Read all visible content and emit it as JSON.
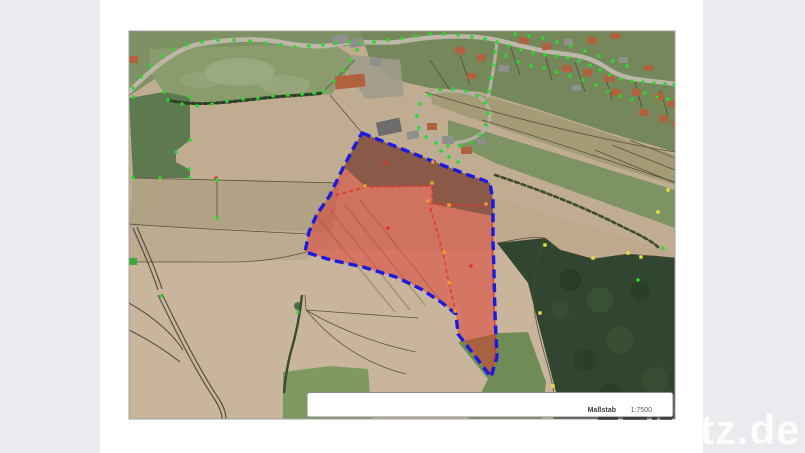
{
  "window": {
    "background_color": "#e9ebee",
    "paper_color": "#ffffff"
  },
  "map": {
    "scale_box": {
      "label": "Maßstab",
      "value": "1:7500"
    },
    "watermark_text": "tz.de",
    "colors": {
      "selection_outline": "#1b1bdf",
      "selection_fill": "rgba(224,56,44,0.5)",
      "selection_fill_dark": "rgba(45,55,40,0.42)",
      "cadastral_line": "#e6392b",
      "survey_point": "#2bd82b",
      "boundary_point": "#e6e03c",
      "vertex_point": "#f59a23",
      "label_point": "#e03125",
      "house_red": "#b2613f",
      "house_gray": "#8f8f8d",
      "house_dark": "#6c6c6a",
      "house_shed": "#3aa83a",
      "scalebar": "#3f3f3f"
    },
    "selected_parcel": {
      "outer": [
        [
          362,
          133
        ],
        [
          402,
          149
        ],
        [
          442,
          165
        ],
        [
          471,
          176
        ],
        [
          483,
          180
        ],
        [
          490,
          183
        ],
        [
          493,
          201
        ],
        [
          493,
          242
        ],
        [
          494,
          272
        ],
        [
          495,
          314
        ],
        [
          497,
          357
        ],
        [
          491,
          377
        ],
        [
          458,
          334
        ],
        [
          456,
          314
        ],
        [
          441,
          302
        ],
        [
          421,
          289
        ],
        [
          396,
          277
        ],
        [
          363,
          267
        ],
        [
          331,
          260
        ],
        [
          305,
          252
        ],
        [
          309,
          232
        ],
        [
          317,
          214
        ],
        [
          329,
          197
        ],
        [
          343,
          168
        ],
        [
          354,
          147
        ]
      ],
      "dark_overlay": [
        [
          362,
          133
        ],
        [
          471,
          176
        ],
        [
          483,
          180
        ],
        [
          490,
          183
        ],
        [
          493,
          201
        ],
        [
          493,
          216
        ],
        [
          453,
          208
        ],
        [
          433,
          204
        ],
        [
          432,
          186
        ],
        [
          366,
          187
        ],
        [
          344,
          167
        ],
        [
          354,
          147
        ]
      ]
    },
    "inner_lines": [
      "M329,197 L366,187 L432,186 L432,204 L487,206",
      "M428,201 C436,226 442,249 445,263 C448,280 452,297 456,313",
      "M492,216 C493,252 493,292 495,330 C496,348 494,362 490,375"
    ],
    "green_points": [
      [
        133,
        88
      ],
      [
        141,
        77
      ],
      [
        150,
        66
      ],
      [
        161,
        56
      ],
      [
        173,
        49
      ],
      [
        187,
        45
      ],
      [
        202,
        42
      ],
      [
        218,
        40
      ],
      [
        234,
        40
      ],
      [
        250,
        41
      ],
      [
        266,
        43
      ],
      [
        281,
        45
      ],
      [
        295,
        47
      ],
      [
        309,
        46
      ],
      [
        323,
        45
      ],
      [
        336,
        43
      ],
      [
        349,
        42
      ],
      [
        361,
        43
      ],
      [
        374,
        42
      ],
      [
        388,
        40
      ],
      [
        402,
        38
      ],
      [
        416,
        36
      ],
      [
        430,
        34
      ],
      [
        444,
        34
      ],
      [
        458,
        35
      ],
      [
        472,
        37
      ],
      [
        485,
        39
      ],
      [
        497,
        42
      ],
      [
        509,
        46
      ],
      [
        521,
        50
      ],
      [
        533,
        53
      ],
      [
        545,
        55
      ],
      [
        557,
        56
      ],
      [
        568,
        58
      ],
      [
        579,
        61
      ],
      [
        590,
        65
      ],
      [
        600,
        70
      ],
      [
        610,
        75
      ],
      [
        621,
        79
      ],
      [
        632,
        81
      ],
      [
        643,
        82
      ],
      [
        654,
        83
      ],
      [
        665,
        84
      ],
      [
        674,
        85
      ],
      [
        420,
        104
      ],
      [
        417,
        116
      ],
      [
        419,
        128
      ],
      [
        426,
        137
      ],
      [
        436,
        143
      ],
      [
        448,
        146
      ],
      [
        460,
        146
      ],
      [
        471,
        142
      ],
      [
        480,
        135
      ],
      [
        486,
        125
      ],
      [
        488,
        113
      ],
      [
        485,
        103
      ],
      [
        477,
        96
      ],
      [
        466,
        91
      ],
      [
        453,
        89
      ],
      [
        440,
        90
      ],
      [
        429,
        95
      ],
      [
        495,
        52
      ],
      [
        493,
        65
      ],
      [
        491,
        78
      ],
      [
        489,
        91
      ],
      [
        441,
        151
      ],
      [
        449,
        157
      ],
      [
        458,
        162
      ],
      [
        168,
        100
      ],
      [
        182,
        104
      ],
      [
        197,
        106
      ],
      [
        212,
        104
      ],
      [
        227,
        101
      ],
      [
        243,
        99
      ],
      [
        258,
        98
      ],
      [
        273,
        96
      ],
      [
        288,
        95
      ],
      [
        302,
        94
      ],
      [
        314,
        93
      ],
      [
        324,
        91
      ],
      [
        334,
        81
      ],
      [
        343,
        70
      ],
      [
        351,
        60
      ],
      [
        357,
        50
      ],
      [
        133,
        97
      ],
      [
        164,
        92
      ],
      [
        189,
        97
      ],
      [
        190,
        140
      ],
      [
        176,
        152
      ],
      [
        189,
        169
      ],
      [
        133,
        177
      ],
      [
        160,
        178
      ],
      [
        189,
        178
      ],
      [
        217,
        180
      ],
      [
        217,
        218
      ],
      [
        298,
        312
      ],
      [
        161,
        296
      ],
      [
        506,
        56
      ],
      [
        518,
        62
      ],
      [
        531,
        66
      ],
      [
        544,
        68
      ],
      [
        557,
        72
      ],
      [
        570,
        76
      ],
      [
        583,
        80
      ],
      [
        596,
        85
      ],
      [
        608,
        91
      ],
      [
        620,
        96
      ],
      [
        632,
        99
      ],
      [
        645,
        93
      ],
      [
        657,
        97
      ],
      [
        668,
        99
      ],
      [
        627,
        66
      ],
      [
        613,
        61
      ],
      [
        599,
        56
      ],
      [
        585,
        51
      ],
      [
        571,
        46
      ],
      [
        557,
        42
      ],
      [
        543,
        38
      ],
      [
        529,
        36
      ],
      [
        515,
        34
      ],
      [
        663,
        248
      ],
      [
        638,
        280
      ]
    ],
    "yellow_points": [
      [
        545,
        245
      ],
      [
        540,
        313
      ],
      [
        553,
        386
      ],
      [
        593,
        258
      ],
      [
        628,
        253
      ],
      [
        641,
        257
      ],
      [
        658,
        212
      ],
      [
        668,
        190
      ],
      [
        676,
        160
      ]
    ],
    "orange_points": [
      [
        365,
        186
      ],
      [
        432,
        183
      ],
      [
        428,
        201
      ],
      [
        449,
        205
      ],
      [
        444,
        252
      ],
      [
        449,
        283
      ],
      [
        455,
        311
      ],
      [
        433,
        162
      ],
      [
        486,
        204
      ]
    ],
    "red_points": [
      [
        385,
        163
      ],
      [
        388,
        228
      ],
      [
        471,
        266
      ],
      [
        216,
        178
      ]
    ],
    "houses": [
      [
        332,
        35,
        16,
        9,
        -8,
        "g"
      ],
      [
        350,
        39,
        14,
        8,
        -8,
        "g"
      ],
      [
        335,
        75,
        30,
        13,
        -6,
        "r"
      ],
      [
        370,
        58,
        11,
        8,
        0,
        "g"
      ],
      [
        129,
        56,
        9,
        7,
        0,
        "r"
      ],
      [
        455,
        47,
        10,
        7,
        10,
        "r"
      ],
      [
        477,
        54,
        9,
        7,
        -5,
        "r"
      ],
      [
        499,
        65,
        10,
        7,
        5,
        "g"
      ],
      [
        467,
        73,
        9,
        6,
        0,
        "r"
      ],
      [
        519,
        37,
        10,
        7,
        5,
        "r"
      ],
      [
        542,
        43,
        9,
        7,
        -5,
        "r"
      ],
      [
        564,
        39,
        9,
        6,
        0,
        "g"
      ],
      [
        587,
        37,
        10,
        7,
        8,
        "r"
      ],
      [
        611,
        33,
        9,
        6,
        0,
        "r"
      ],
      [
        562,
        65,
        10,
        7,
        -6,
        "r"
      ],
      [
        583,
        69,
        9,
        7,
        4,
        "r"
      ],
      [
        604,
        75,
        10,
        7,
        0,
        "r"
      ],
      [
        572,
        85,
        9,
        6,
        -4,
        "g"
      ],
      [
        611,
        89,
        10,
        7,
        6,
        "r"
      ],
      [
        632,
        89,
        9,
        7,
        0,
        "r"
      ],
      [
        654,
        93,
        10,
        7,
        -6,
        "r"
      ],
      [
        667,
        101,
        9,
        6,
        0,
        "r"
      ],
      [
        639,
        109,
        10,
        7,
        5,
        "r"
      ],
      [
        659,
        115,
        9,
        7,
        -5,
        "r"
      ],
      [
        672,
        121,
        8,
        6,
        0,
        "r"
      ],
      [
        619,
        57,
        9,
        6,
        0,
        "g"
      ],
      [
        644,
        65,
        9,
        6,
        4,
        "r"
      ],
      [
        377,
        120,
        24,
        14,
        -12,
        "d"
      ],
      [
        407,
        131,
        12,
        8,
        -10,
        "g"
      ],
      [
        427,
        123,
        10,
        7,
        0,
        "r"
      ],
      [
        442,
        136,
        12,
        8,
        5,
        "g"
      ],
      [
        461,
        147,
        11,
        7,
        0,
        "r"
      ],
      [
        477,
        139,
        9,
        6,
        0,
        "g"
      ],
      [
        128,
        258,
        9,
        7,
        0,
        "s"
      ]
    ],
    "scalebar_segments": [
      [
        598,
        20
      ],
      [
        623,
        24
      ],
      [
        652,
        5
      ],
      [
        660,
        12
      ]
    ]
  }
}
